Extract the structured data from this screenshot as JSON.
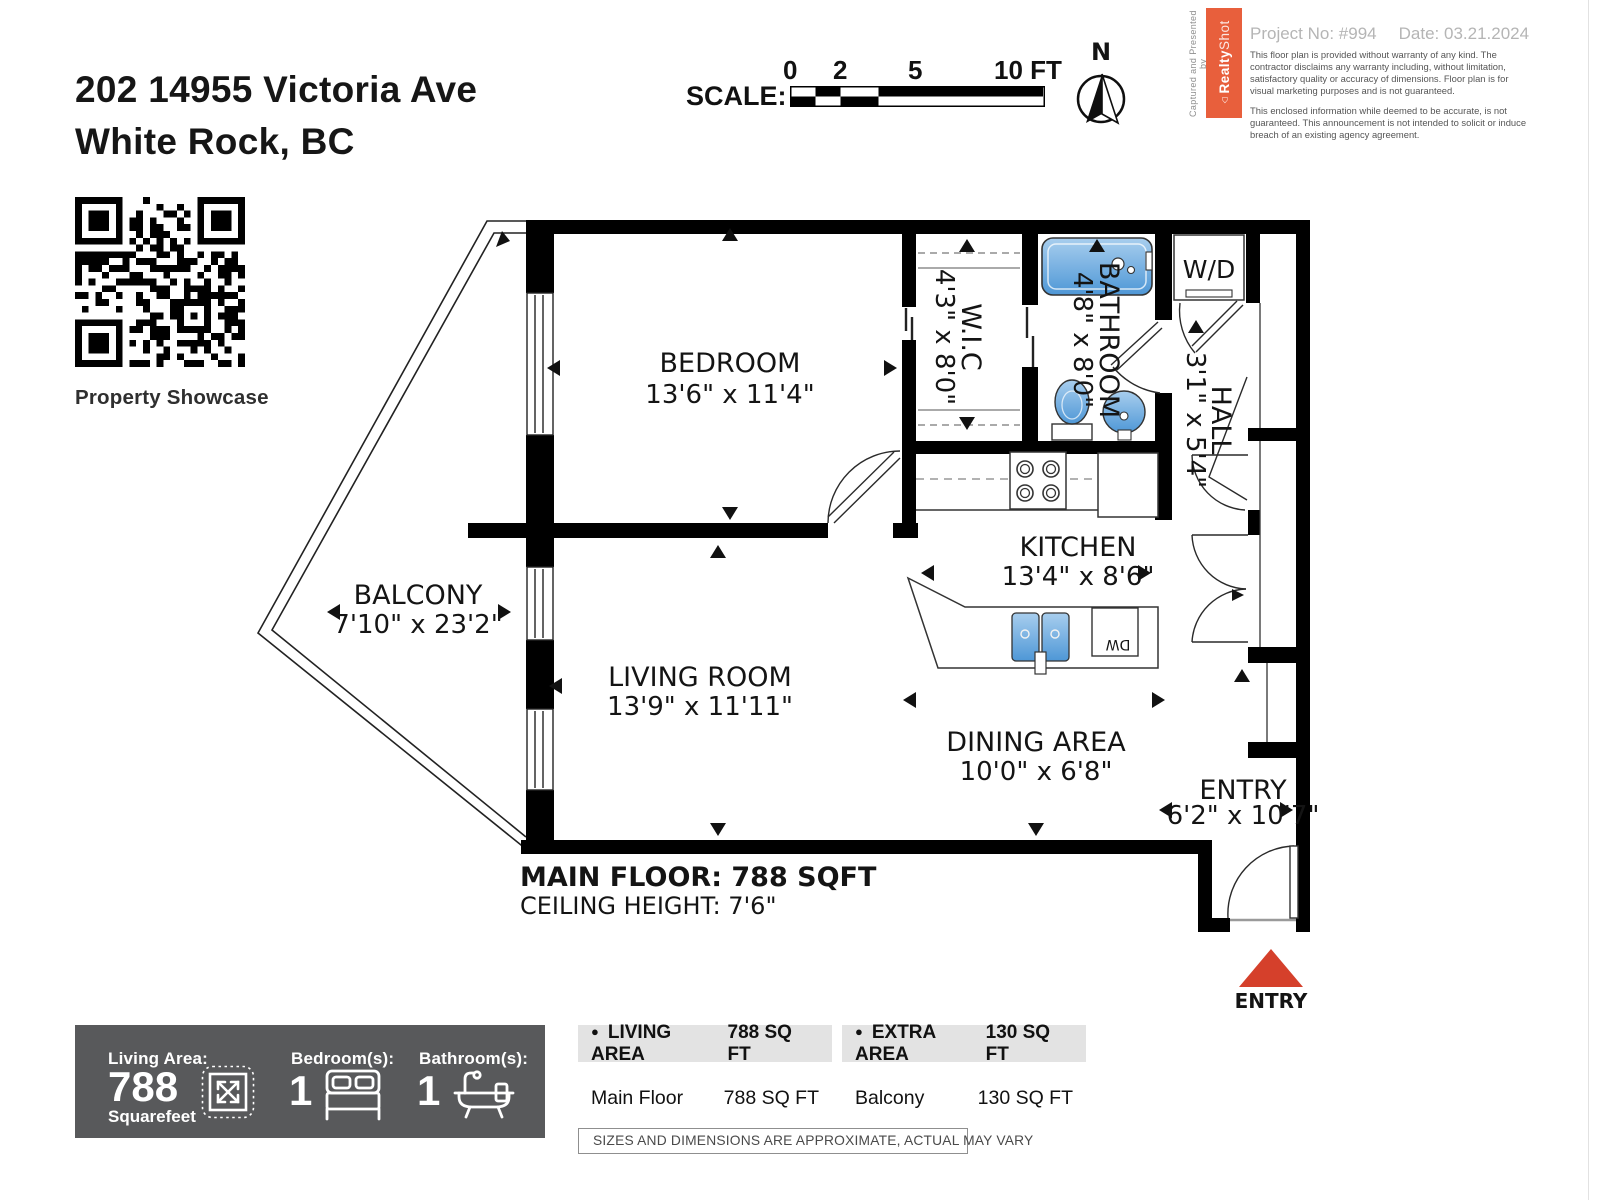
{
  "page": {
    "address_line1": "202 14955 Victoria Ave",
    "address_line2": "White Rock, BC"
  },
  "scale_bar": {
    "label": "SCALE:",
    "tick0": "0",
    "tick2": "2",
    "tick5": "5",
    "tick10": "10 FT"
  },
  "compass": {
    "north": "N"
  },
  "branding": {
    "captured": "Captured and Presented by",
    "brand_bold": "Realty",
    "brand_light": "Shot",
    "project": "Project No: #994",
    "date": "Date: 03.21.2024",
    "disclaimer1": "This floor plan is provided without warranty of any kind. The contractor disclaims any warranty including, without limitation, satisfactory quality or accuracy of dimensions. Floor plan is for visual marketing purposes and is not guaranteed.",
    "disclaimer2": "This enclosed information while deemed to be accurate, is not guaranteed. This announcement is not intended to solicit or induce breach of an existing agency agreement."
  },
  "qr": {
    "caption": "Property Showcase"
  },
  "floorplan": {
    "rooms": {
      "bedroom": {
        "name": "BEDROOM",
        "dims": "13'6\" x 11'4\""
      },
      "wic": {
        "name": "W.I.C",
        "dims": "4'3\" x 8'0\""
      },
      "bathroom": {
        "name": "BATHROOM",
        "dims": "4'8\" x 8'0\""
      },
      "hall": {
        "name": "HALL",
        "dims": "3'1\" x 5'4\""
      },
      "kitchen": {
        "name": "KITCHEN",
        "dims": "13'4\" x 8'6\""
      },
      "living": {
        "name": "LIVING ROOM",
        "dims": "13'9\" x 11'11\""
      },
      "dining": {
        "name": "DINING AREA",
        "dims": "10'0\" x 6'8\""
      },
      "balcony": {
        "name": "BALCONY",
        "dims": "7'10\" x 23'2\""
      },
      "entry": {
        "name": "ENTRY",
        "dims": "6'2\" x 10'7\""
      }
    },
    "wd_label": "W/D",
    "dw_label": "DW",
    "main_floor": "MAIN FLOOR: 788 SQFT",
    "ceiling": "CEILING HEIGHT: 7'6\"",
    "entry_marker": "ENTRY"
  },
  "summary": {
    "living_area_label": "Living Area:",
    "living_area_value": "788",
    "living_area_unit": "Squarefeet",
    "bedrooms_label": "Bedroom(s):",
    "bedrooms_value": "1",
    "bathrooms_label": "Bathroom(s):",
    "bathrooms_value": "1"
  },
  "area_tables": {
    "living": {
      "header": "LIVING AREA",
      "header_value": "788 SQ FT",
      "row_label": "Main Floor",
      "row_value": "788 SQ FT"
    },
    "extra": {
      "header": "EXTRA AREA",
      "header_value": "130 SQ FT",
      "row_label": "Balcony",
      "row_value": "130 SQ FT"
    }
  },
  "note": "SIZES AND DIMENSIONS ARE APPROXIMATE, ACTUAL MAY VARY",
  "colors": {
    "brand_orange": "#E85F3C",
    "entry_red": "#D5402B",
    "fixture_blue_light": "#A8CEEE",
    "fixture_blue_dark": "#4E97D6",
    "summary_bar_gray": "#58595B",
    "wall_black": "#000000"
  }
}
